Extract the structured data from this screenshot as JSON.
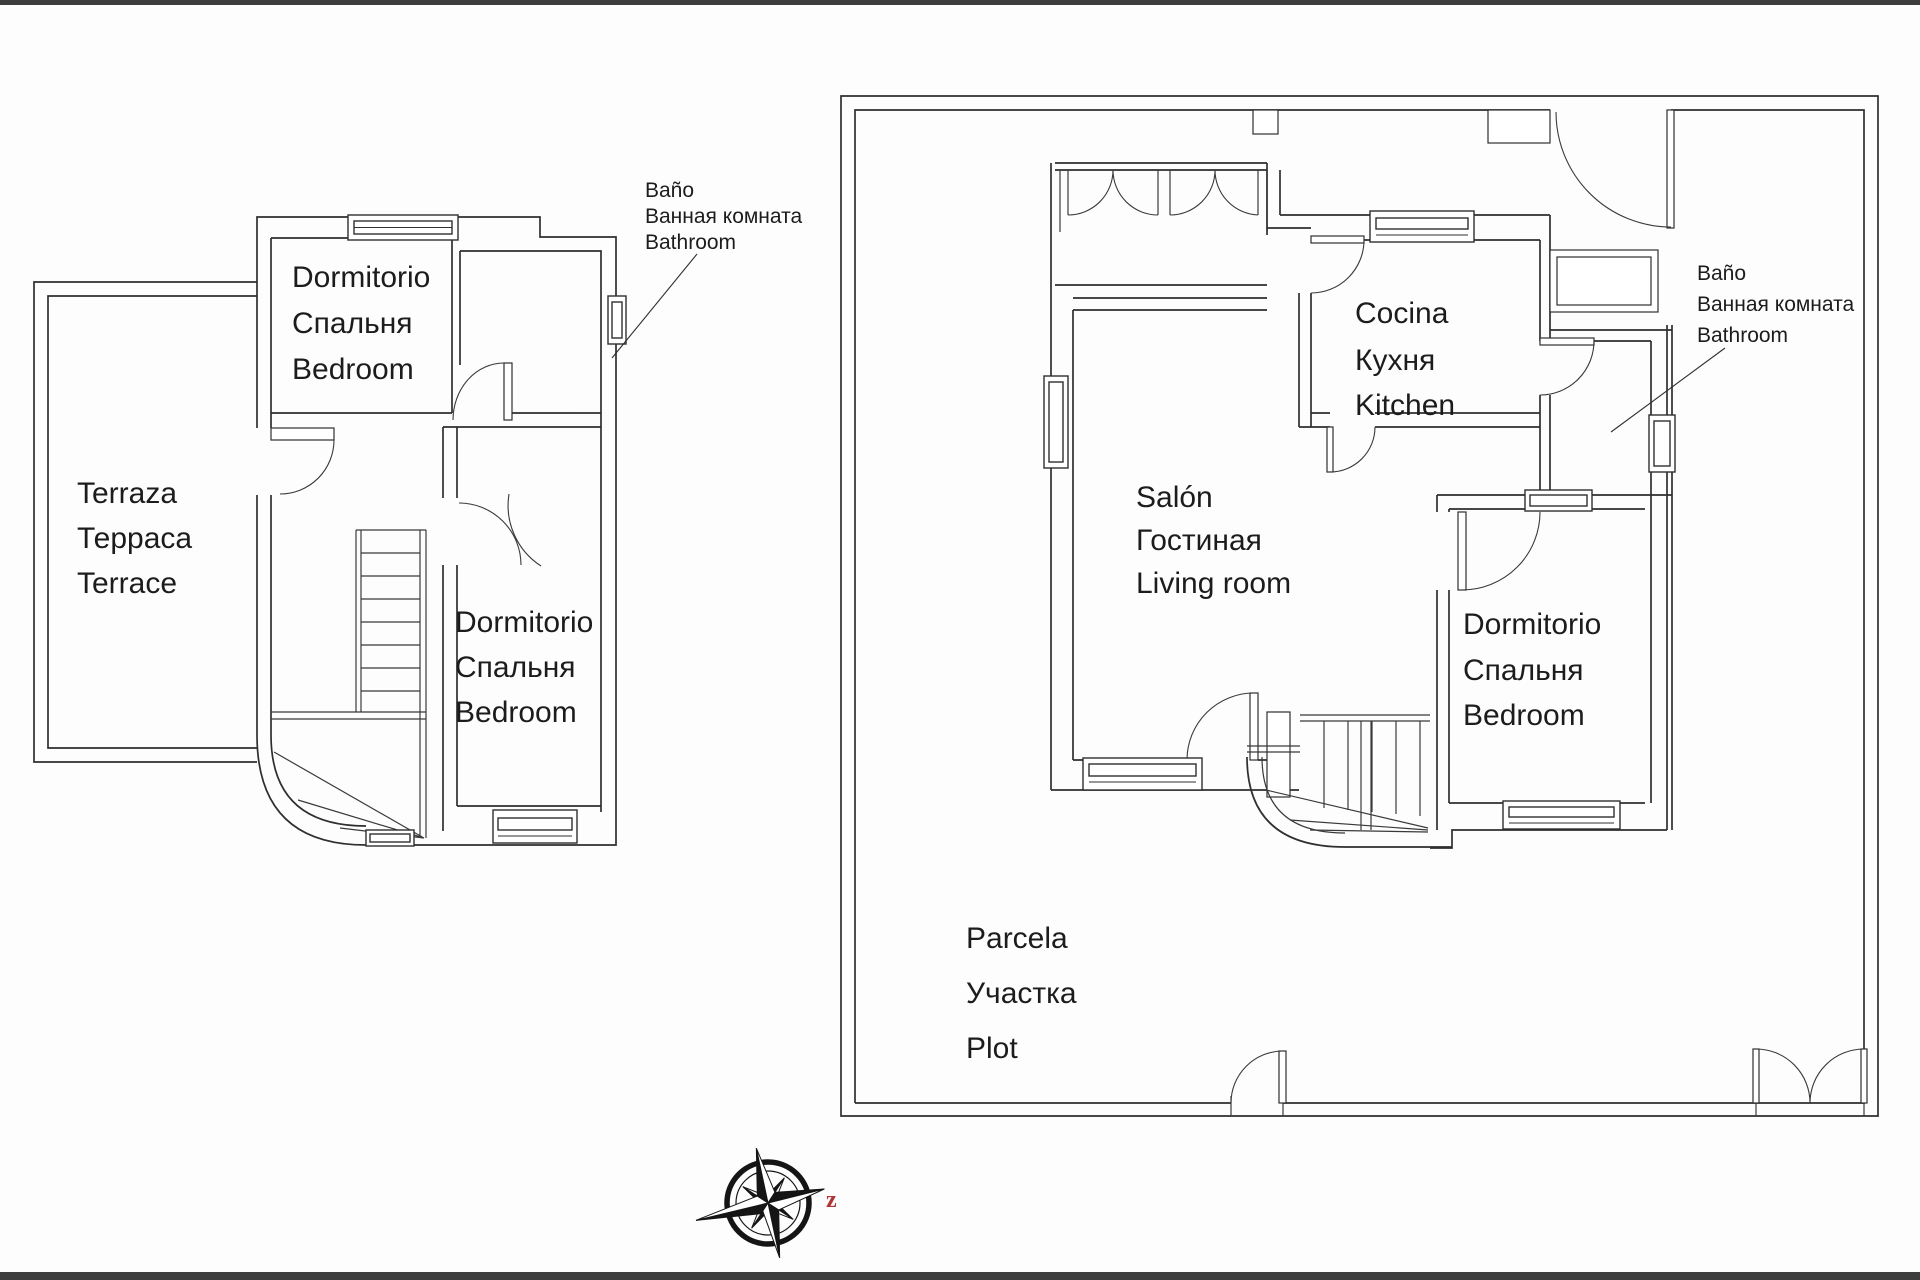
{
  "document": {
    "type": "floor-plan-drawing",
    "background_color": "#fdfdfd",
    "line_color": "#2f2f2f",
    "letterbox_color": "#3d3d3d",
    "accent_red": "#b03535"
  },
  "left_plan": {
    "terrace": {
      "es": "Terraza",
      "ru": "Терраса",
      "en": "Terrace"
    },
    "bedroom_top": {
      "es": "Dormitorio",
      "ru": "Спальня",
      "en": "Bedroom"
    },
    "bedroom_bottom": {
      "es": "Dormitorio",
      "ru": "Спальня",
      "en": "Bedroom"
    },
    "bathroom": {
      "es": "Baño",
      "ru": "Ванная комната",
      "en": "Bathroom"
    }
  },
  "right_plan": {
    "kitchen": {
      "es": "Cocina",
      "ru": "Кухня",
      "en": "Kitchen"
    },
    "living": {
      "es": "Salón",
      "ru": "Гостиная",
      "en": "Living room"
    },
    "bedroom": {
      "es": "Dormitorio",
      "ru": "Спальня",
      "en": "Bedroom"
    },
    "bathroom": {
      "es": "Baño",
      "ru": "Ванная комната",
      "en": "Bathroom"
    },
    "plot": {
      "es": "Parcela",
      "ru": "Участка",
      "en": "Plot"
    }
  },
  "compass": {
    "east_letter": "z",
    "east_letter_color": "#b03535"
  }
}
